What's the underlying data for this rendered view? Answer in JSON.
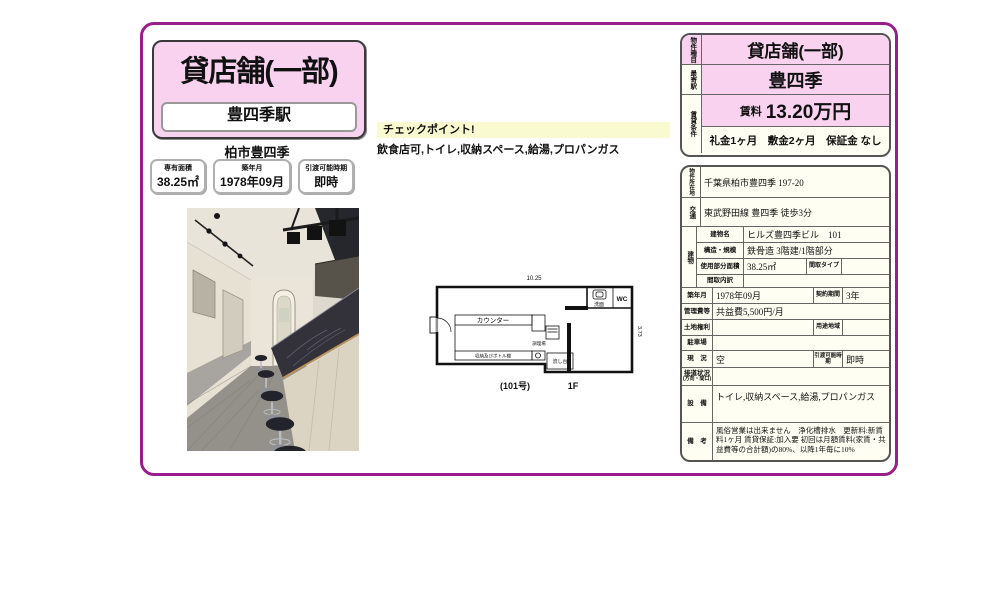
{
  "colors": {
    "frame_border": "#9a1d8c",
    "pink_fill": "#f8d2ee",
    "ivory_fill": "#fffef2",
    "checkpoint_yellow": "#fafad0"
  },
  "left": {
    "property_type": "貸店舗(一部)",
    "station": "豊四季駅",
    "city": "柏市豊四季",
    "stats": [
      {
        "label": "専有面積",
        "value": "38.25㎡"
      },
      {
        "label": "築年月",
        "value": "1978年09月"
      },
      {
        "label": "引渡可能時期",
        "value": "即時"
      }
    ]
  },
  "checkpoint": {
    "title": "チェックポイント!",
    "text": "飲食店可,トイレ,収納スペース,給湯,プロパンガス"
  },
  "floorplan": {
    "width_dim": "10.25",
    "depth_dim": "3.73",
    "labels": {
      "washroom": "洗面",
      "wc": "WC",
      "counter": "カウンター",
      "kitchen": "調理場",
      "storage": "収納及びボトル棚",
      "sink": "流し台"
    },
    "unit": "(101号)",
    "floor": "1F"
  },
  "panel": {
    "summary": {
      "type_label": "物件種目",
      "type_value": "貸店舗(一部)",
      "station_label": "最寄駅",
      "station_value": "豊四季",
      "terms_label": "賃貸条件",
      "rent_label": "賃料",
      "rent_value": "13.20万円",
      "fees": "礼金1ヶ月　敷金2ヶ月　保証金 なし"
    },
    "details": {
      "address_label": "物件所在地",
      "address": "千葉県柏市豊四季 197-20",
      "access_label": "交通",
      "access": "東武野田線 豊四季 徒歩3分",
      "building_label": "建物",
      "building_name_label": "建物名",
      "building_name": "ヒルズ豊四季ビル　101",
      "structure_label": "構造・規模",
      "structure": "鉄骨造 3階建/1階部分",
      "area_label": "使用部分面積",
      "area": "38.25㎡",
      "layout_type_label": "間取タイプ",
      "layout_type": "",
      "layout_detail_label": "間取内訳",
      "layout_detail": "",
      "built_label": "築年月",
      "built": "1978年09月",
      "contract_label": "契約期間",
      "contract": "3年",
      "mgmt_label": "管理費等",
      "mgmt": "共益費5,500円/月",
      "land_label": "土地権利",
      "land": "",
      "zoning_label": "用途地域",
      "zoning": "",
      "parking_label": "駐車場",
      "parking": "",
      "status_label": "現　況",
      "status": "空",
      "handover_label": "引渡可能時期",
      "handover": "即時",
      "road_label": "接道状況",
      "road_label2": "(方向・間口)",
      "road": "",
      "equip_label": "設　備",
      "equip": "トイレ,収納スペース,給湯,プロパンガス",
      "remarks_label": "備　考",
      "remarks": "風俗営業は出来ません　浄化槽排水　更新料:新賃料1ヶ月 賃貸保証:加入要 初回は月額賃料(家賃・共益費等の合計額)の80%、以降1年毎に10%"
    }
  }
}
